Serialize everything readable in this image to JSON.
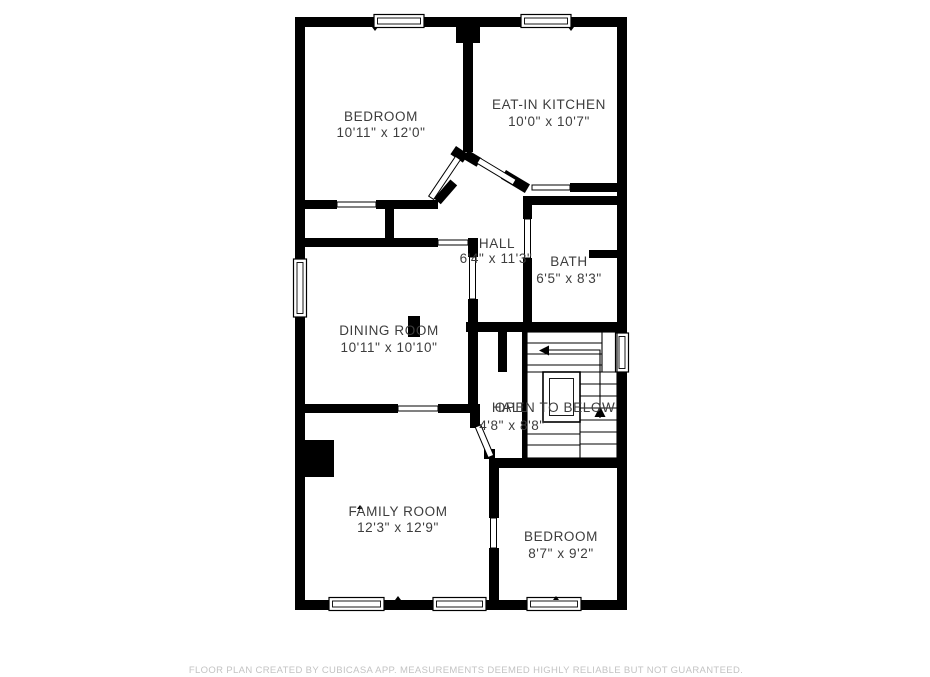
{
  "colors": {
    "background": "#ffffff",
    "wall": "#000000",
    "room_label": "#3d3d3d",
    "footer_text": "#c3c3c3"
  },
  "rooms": [
    {
      "name": "BEDROOM",
      "dimensions": "10'11\" x 12'0\""
    },
    {
      "name": "EAT-IN KITCHEN",
      "dimensions": "10'0\" x 10'7\""
    },
    {
      "name": "HALL",
      "dimensions": "6'4\" x 11'3\""
    },
    {
      "name": "BATH",
      "dimensions": "6'5\" x 8'3\""
    },
    {
      "name": "DINING ROOM",
      "dimensions": "10'11\" x 10'10\""
    },
    {
      "name": "HALL",
      "dimensions": "4'8\" x 8'8\""
    },
    {
      "name": "OPEN TO BELOW",
      "dimensions": ""
    },
    {
      "name": "FAMILY ROOM",
      "dimensions": "12'3\" x 12'9\""
    },
    {
      "name": "BEDROOM",
      "dimensions": "8'7\" x 9'2\""
    }
  ],
  "footer": {
    "text": "FLOOR PLAN CREATED BY CUBICASA APP. MEASUREMENTS DEEMED HIGHLY RELIABLE BUT NOT GUARANTEED."
  }
}
